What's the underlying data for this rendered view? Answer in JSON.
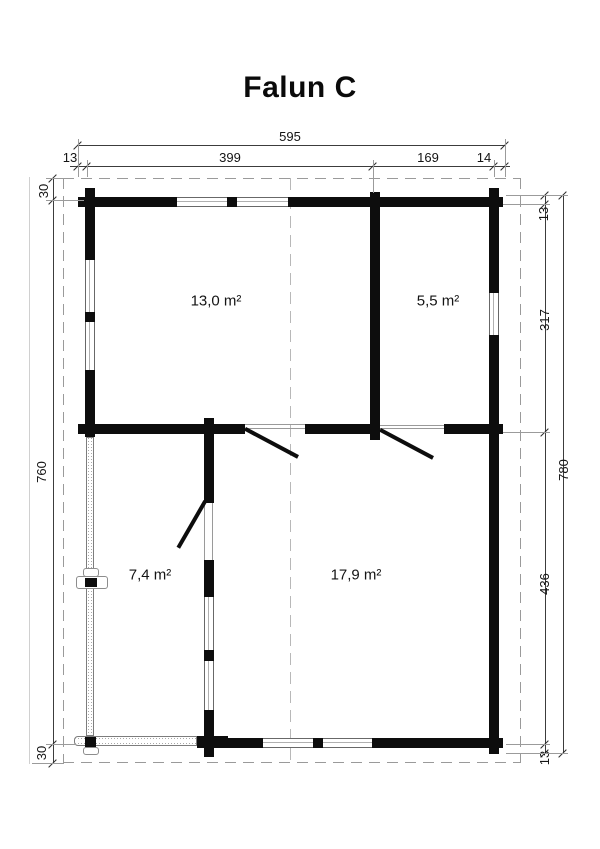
{
  "title": "Falun C",
  "colors": {
    "wall": "#0d0d0d",
    "dimension_line": "#3c3c3c",
    "dashed_outline": "#9a9a9a",
    "background": "#ffffff"
  },
  "plan": {
    "rooms": [
      {
        "id": "room-top-left",
        "area_label": "13,0 m²"
      },
      {
        "id": "room-top-right",
        "area_label": "5,5 m²"
      },
      {
        "id": "terrace",
        "area_label": "7,4 m²"
      },
      {
        "id": "room-bottom-right",
        "area_label": "17,9 m²"
      }
    ],
    "dimensions": {
      "top_total": "595",
      "top_chain": [
        "13",
        "399",
        "169",
        "14"
      ],
      "left_chain": [
        "30",
        "760",
        "30"
      ],
      "right_chain": [
        "13",
        "317",
        "436",
        "13"
      ],
      "right_total": "780"
    }
  }
}
